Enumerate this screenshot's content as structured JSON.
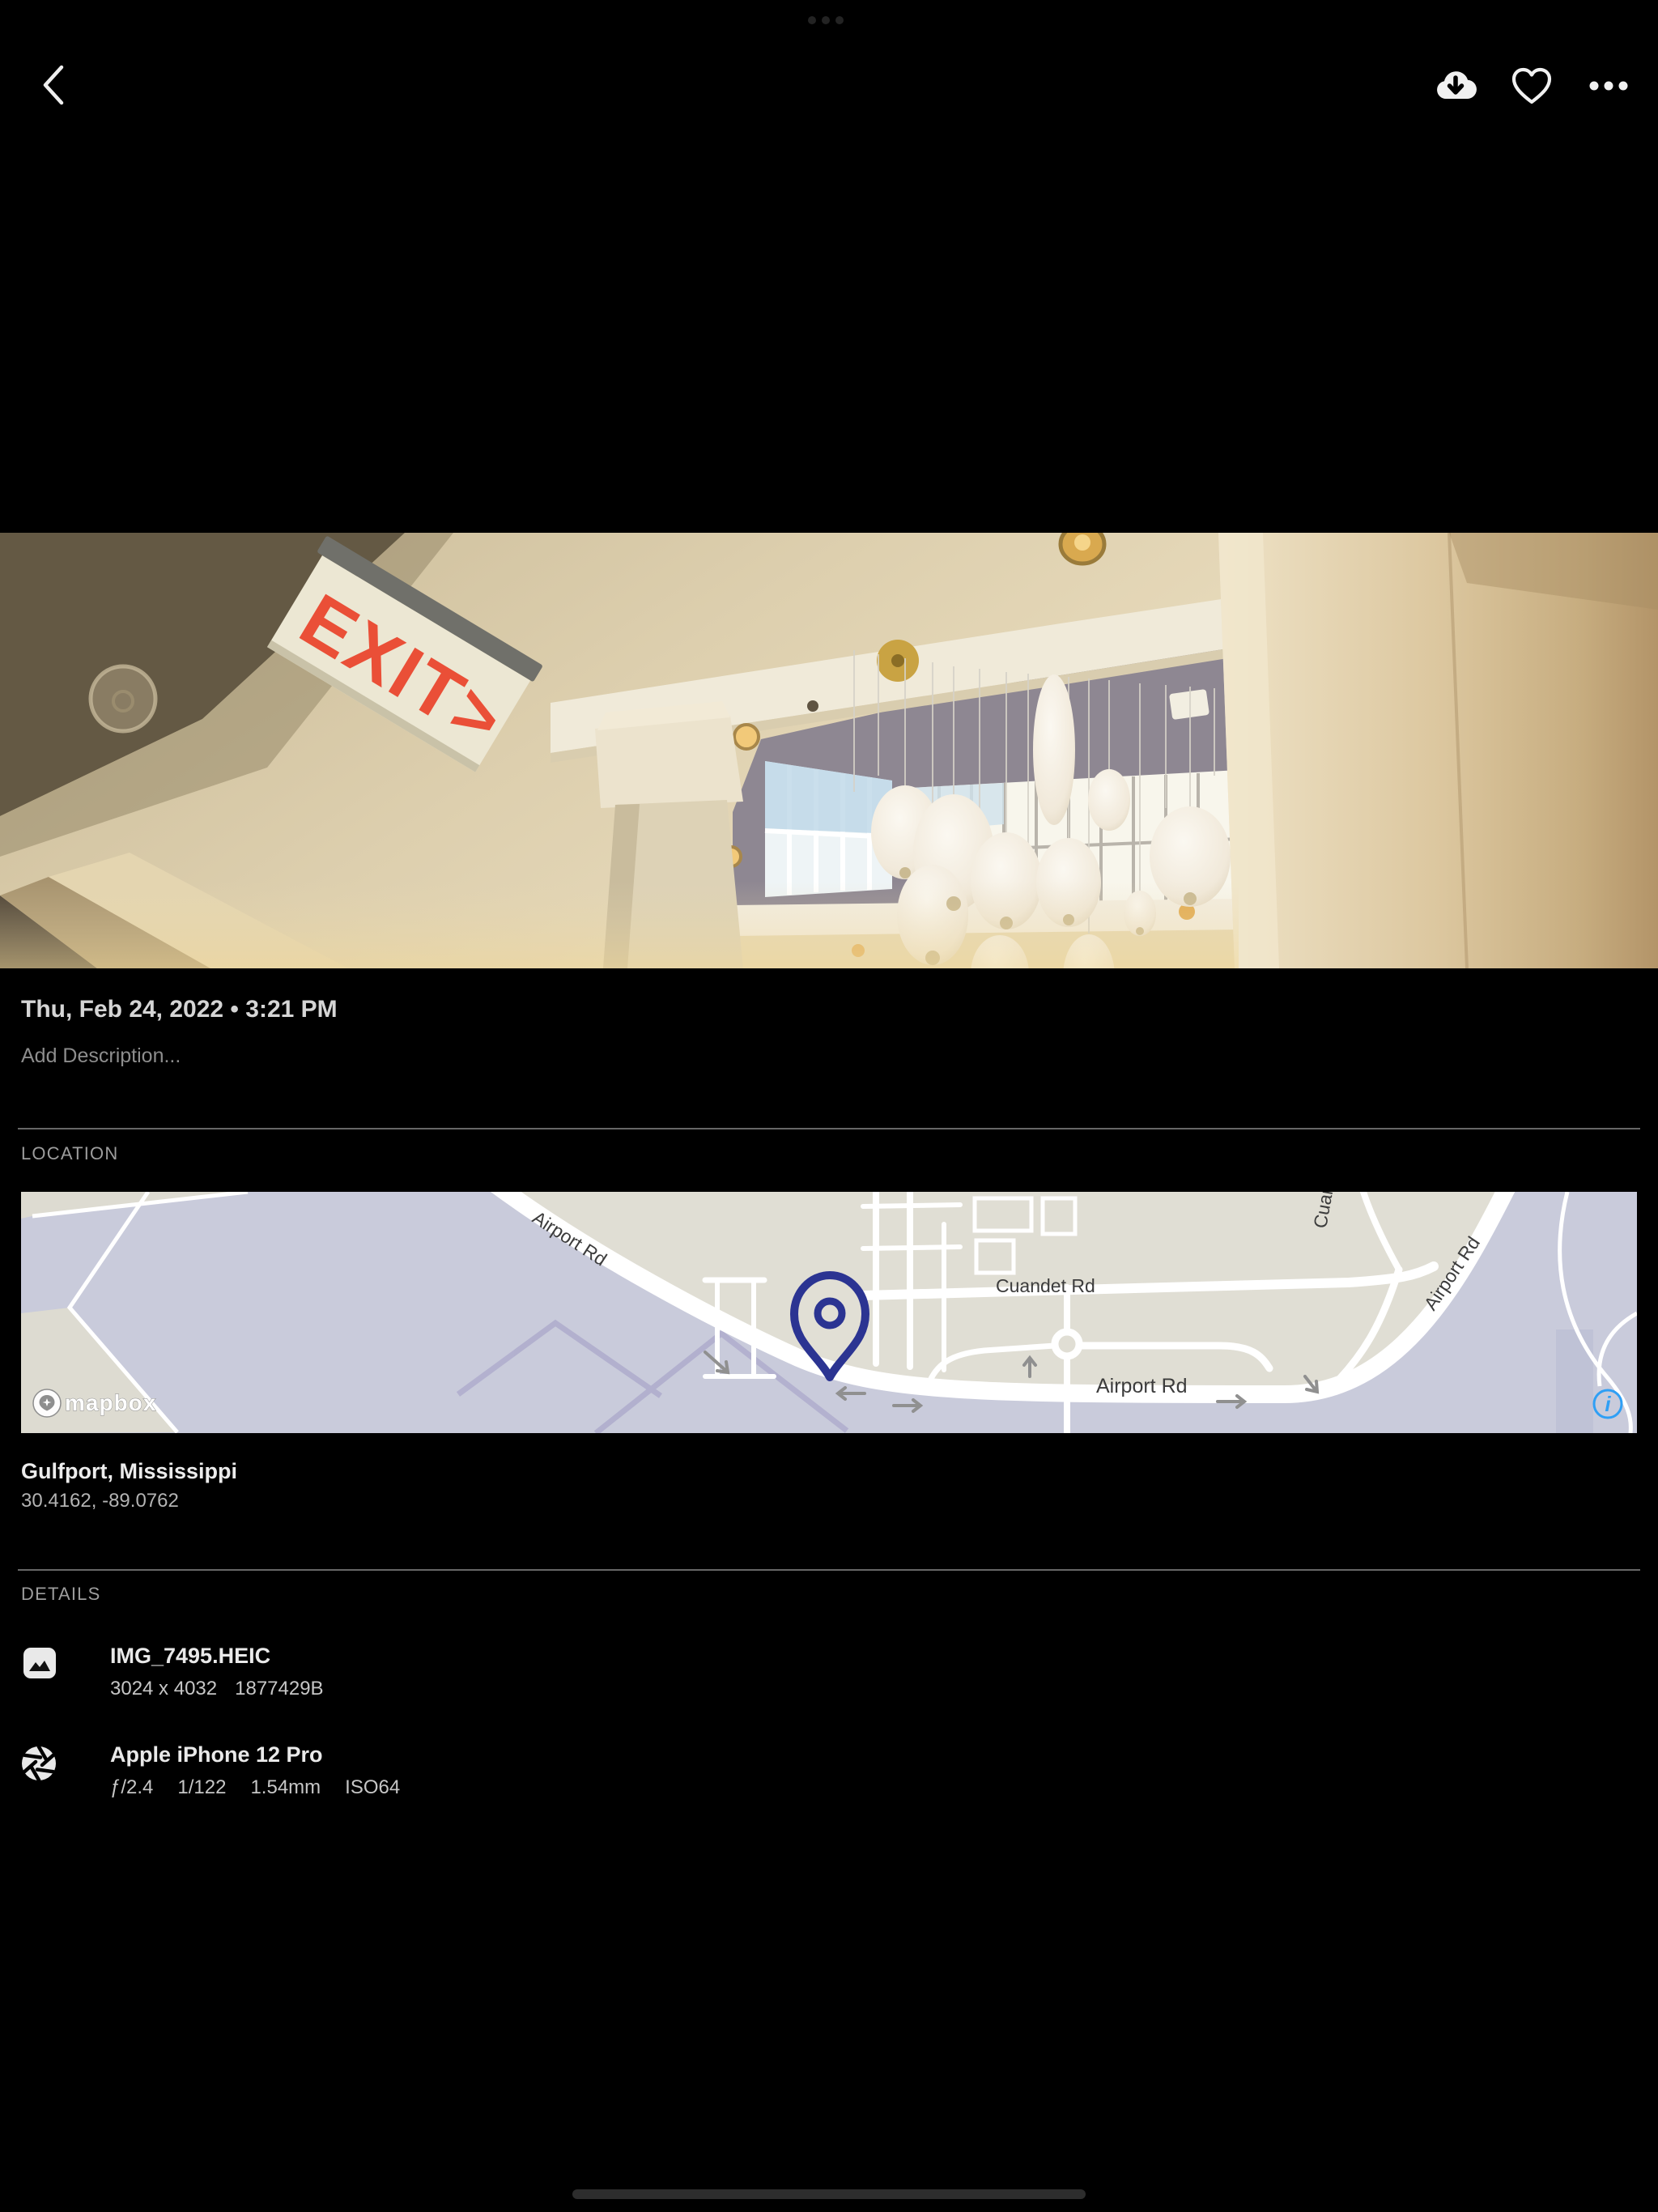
{
  "topbar": {
    "back_icon": "chevron-left",
    "download_icon": "cloud-download",
    "favorite_icon": "heart-outline",
    "more_icon": "ellipsis-horizontal"
  },
  "photo": {
    "taken_at": "Thu, Feb 24, 2022 • 3:21 PM",
    "description_placeholder": "Add Description...",
    "exit_sign_text": "EXIT>"
  },
  "location": {
    "header": "LOCATION",
    "place": "Gulfport, Mississippi",
    "coordinates": "30.4162, -89.0762",
    "map": {
      "road_label_airport": "Airport Rd",
      "road_label_cuandet": "Cuandet Rd",
      "road_label_airport2": "Airport Rd",
      "road_label_airport_diag": "Airport Rd",
      "road_label_partial": "Cuandet",
      "attribution": "mapbox",
      "info_glyph": "i",
      "pin_color": "#2b3492",
      "land_color": "#c9cbdb",
      "parcel_color": "#e0ded4",
      "info_color": "#2f9ff5"
    }
  },
  "details": {
    "header": "DETAILS",
    "file": {
      "name": "IMG_7495.HEIC",
      "dimensions": "3024 x 4032",
      "size": "1877429B"
    },
    "camera": {
      "name": "Apple iPhone 12 Pro",
      "aperture": "ƒ/2.4",
      "shutter": "1/122",
      "focal_length": "1.54mm",
      "iso": "ISO64"
    }
  }
}
